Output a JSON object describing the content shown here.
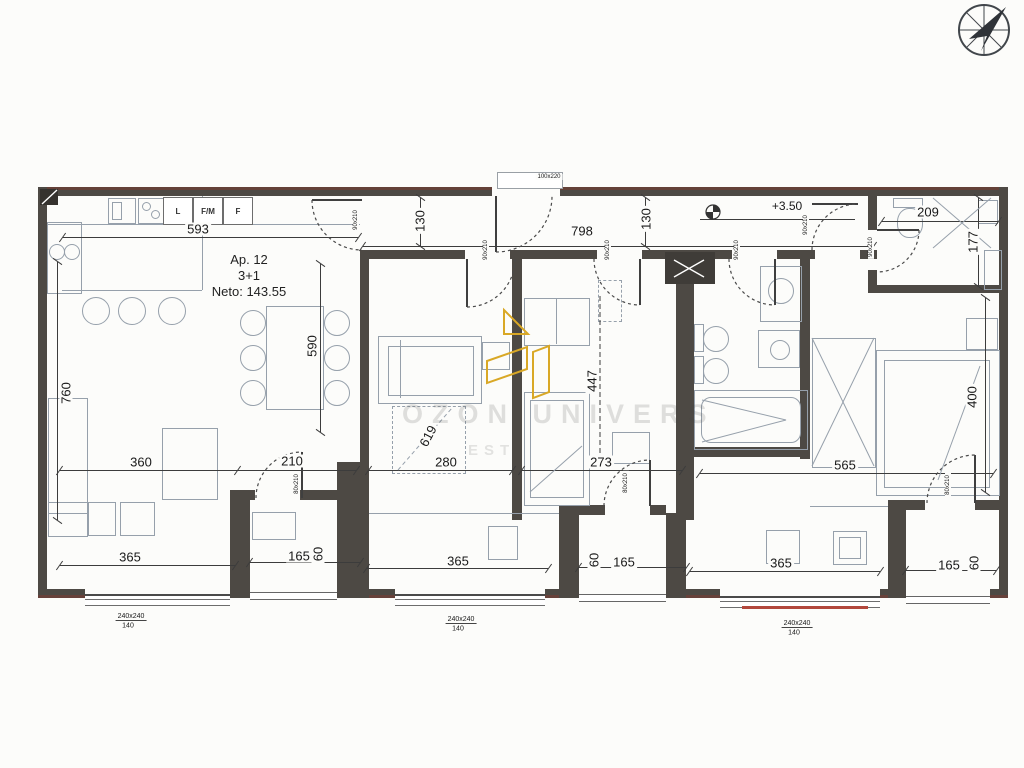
{
  "apartment": {
    "number": "Ap. 12",
    "layout": "3+1",
    "net_area": "Neto: 143.55"
  },
  "kitchen": {
    "appliances": [
      "L",
      "F/M",
      "F"
    ]
  },
  "watermark": {
    "title": "OZON UNIVERS",
    "subtitle": "EST"
  },
  "colors": {
    "wall": "#4d4944",
    "gold_logo": "#D9A826",
    "red_sill": "#b2473c",
    "furniture_line": "#96a0ab",
    "dimension_line": "#3c3c3c"
  },
  "compass": {
    "direction": "north-east"
  },
  "labels": [
    {
      "t": "593",
      "x": 198,
      "y": 229
    },
    {
      "t": "130",
      "x": 420,
      "y": 221,
      "r": -90
    },
    {
      "t": "798",
      "x": 582,
      "y": 231
    },
    {
      "t": "130",
      "x": 646,
      "y": 219,
      "r": -90
    },
    {
      "t": "+3.50",
      "x": 787,
      "y": 206,
      "s": 12
    },
    {
      "t": "209",
      "x": 928,
      "y": 212
    },
    {
      "t": "177",
      "x": 973,
      "y": 242,
      "r": -90
    },
    {
      "t": "760",
      "x": 66,
      "y": 393,
      "r": -90
    },
    {
      "t": "590",
      "x": 312,
      "y": 346,
      "r": -90
    },
    {
      "t": "619",
      "x": 428,
      "y": 436,
      "r": -62
    },
    {
      "t": "447",
      "x": 592,
      "y": 381,
      "r": -90
    },
    {
      "t": "400",
      "x": 972,
      "y": 397,
      "r": -90
    },
    {
      "t": "360",
      "x": 141,
      "y": 462
    },
    {
      "t": "210",
      "x": 292,
      "y": 461
    },
    {
      "t": "280",
      "x": 446,
      "y": 462
    },
    {
      "t": "273",
      "x": 601,
      "y": 462
    },
    {
      "t": "565",
      "x": 845,
      "y": 465
    },
    {
      "t": "365",
      "x": 130,
      "y": 557
    },
    {
      "t": "165",
      "x": 299,
      "y": 556
    },
    {
      "t": "60",
      "x": 318,
      "y": 554,
      "r": -90
    },
    {
      "t": "365",
      "x": 458,
      "y": 561
    },
    {
      "t": "60",
      "x": 594,
      "y": 560,
      "r": -90
    },
    {
      "t": "165",
      "x": 624,
      "y": 562
    },
    {
      "t": "365",
      "x": 781,
      "y": 563
    },
    {
      "t": "165",
      "x": 949,
      "y": 565
    },
    {
      "t": "60",
      "x": 974,
      "y": 563,
      "r": -90
    },
    {
      "t": "240x240",
      "x": 131,
      "y": 617,
      "s": 7,
      "u": 1
    },
    {
      "t": "140",
      "x": 128,
      "y": 626,
      "s": 7
    },
    {
      "t": "240x240",
      "x": 461,
      "y": 620,
      "s": 7,
      "u": 1
    },
    {
      "t": "140",
      "x": 458,
      "y": 629,
      "s": 7
    },
    {
      "t": "240x240",
      "x": 797,
      "y": 624,
      "s": 7,
      "u": 1
    },
    {
      "t": "140",
      "x": 794,
      "y": 633,
      "s": 7
    },
    {
      "t": "90x210",
      "x": 486,
      "y": 250,
      "r": -90,
      "s": 6
    },
    {
      "t": "90x210",
      "x": 608,
      "y": 250,
      "r": -90,
      "s": 6
    },
    {
      "t": "90x210",
      "x": 737,
      "y": 250,
      "r": -90,
      "s": 6
    },
    {
      "t": "90x210",
      "x": 806,
      "y": 225,
      "r": -90,
      "s": 6
    },
    {
      "t": "90x210",
      "x": 871,
      "y": 247,
      "r": -90,
      "s": 6
    },
    {
      "t": "90x210",
      "x": 356,
      "y": 220,
      "r": -90,
      "s": 6
    },
    {
      "t": "80x210",
      "x": 297,
      "y": 484,
      "r": -90,
      "s": 6
    },
    {
      "t": "80x210",
      "x": 626,
      "y": 483,
      "r": -90,
      "s": 6
    },
    {
      "t": "80x210",
      "x": 948,
      "y": 485,
      "r": -90,
      "s": 6
    },
    {
      "t": "100x220",
      "x": 549,
      "y": 177,
      "s": 6
    }
  ]
}
